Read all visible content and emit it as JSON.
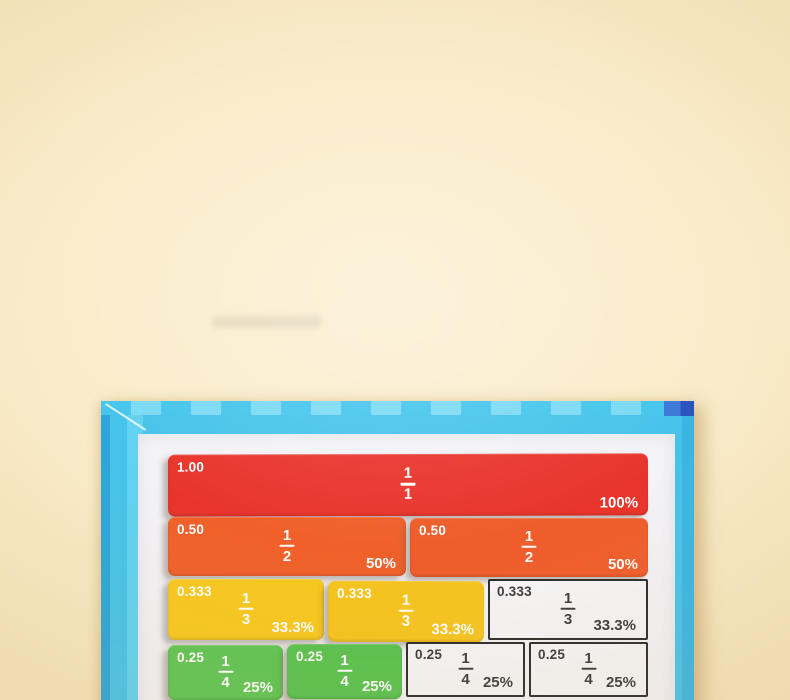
{
  "photo": {
    "description": "Magnetic fraction tiles board on cream backdrop",
    "background_color": "#FAECC9"
  },
  "board": {
    "frame_color": "#45C3EA",
    "frame_edge_color": "#2BA6DA",
    "frame_light_color": "#60D2F1",
    "checker_dark": "#44C5EC",
    "checker_light": "#7ADAF4",
    "corner_patch_color": "#2B55BE",
    "surface_color": "#F3F2F6",
    "printed_cell_color": "#F5F5F7",
    "printed_text_color": "#3B3B3B",
    "printed_border_color": "#2B2B2B"
  },
  "fraction_rows": [
    {
      "name": "wholes",
      "cells": [
        {
          "kind": "tile",
          "color": "#E8342C",
          "text_color": "#FFFFFF",
          "decimal": "1.00",
          "numerator": "1",
          "denominator": "1",
          "percent": "100%"
        }
      ]
    },
    {
      "name": "halves",
      "cells": [
        {
          "kind": "tile",
          "color": "#F0602A",
          "text_color": "#FFFFFF",
          "decimal": "0.50",
          "numerator": "1",
          "denominator": "2",
          "percent": "50%"
        },
        {
          "kind": "tile",
          "color": "#EF5D2B",
          "text_color": "#FFFFFF",
          "decimal": "0.50",
          "numerator": "1",
          "denominator": "2",
          "percent": "50%"
        }
      ]
    },
    {
      "name": "thirds",
      "cells": [
        {
          "kind": "tile",
          "color": "#F8C81F",
          "text_color": "#FFFFFF",
          "decimal": "0.333",
          "numerator": "1",
          "denominator": "3",
          "percent": "33.3%"
        },
        {
          "kind": "tile",
          "color": "#F6C41E",
          "text_color": "#FFFFFF",
          "decimal": "0.333",
          "numerator": "1",
          "denominator": "3",
          "percent": "33.3%"
        },
        {
          "kind": "printed",
          "color": "#F5F5F7",
          "text_color": "#3B3B3B",
          "decimal": "0.333",
          "numerator": "1",
          "denominator": "3",
          "percent": "33.3%"
        }
      ]
    },
    {
      "name": "quarters",
      "cells": [
        {
          "kind": "tile",
          "color": "#5EC553",
          "text_color": "#FFFFFF",
          "decimal": "0.25",
          "numerator": "1",
          "denominator": "4",
          "percent": "25%"
        },
        {
          "kind": "tile",
          "color": "#57C24E",
          "text_color": "#FFFFFF",
          "decimal": "0.25",
          "numerator": "1",
          "denominator": "4",
          "percent": "25%"
        },
        {
          "kind": "printed",
          "color": "#F5F5F7",
          "text_color": "#3B3B3B",
          "decimal": "0.25",
          "numerator": "1",
          "denominator": "4",
          "percent": "25%"
        },
        {
          "kind": "printed",
          "color": "#F5F5F7",
          "text_color": "#3B3B3B",
          "decimal": "0.25",
          "numerator": "1",
          "denominator": "4",
          "percent": "25%"
        }
      ]
    }
  ]
}
